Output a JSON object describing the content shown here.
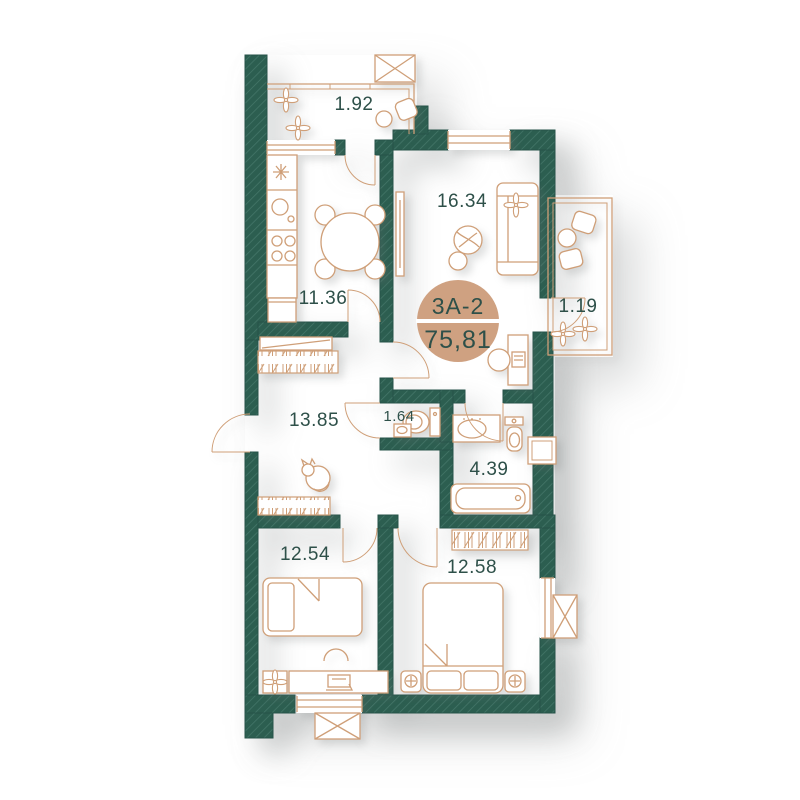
{
  "plan": {
    "unit_id": "3A-2",
    "total_area": "75,81",
    "rooms": {
      "balcony_top": "1.92",
      "living": "16.34",
      "kitchen": "11.36",
      "loggia_right": "1.19",
      "hall": "13.85",
      "wc": "1.64",
      "bathroom": "4.39",
      "bedroom_left": "12.54",
      "bedroom_right": "12.58"
    },
    "colors": {
      "wall": "#2c5e50",
      "wall_hatch_line": "#45776a",
      "furniture_line": "#cf9f78",
      "label_text": "#2e5049",
      "badge_fill": "#cfa181",
      "badge_divider": "#ffffff",
      "background": "#ffffff"
    }
  }
}
